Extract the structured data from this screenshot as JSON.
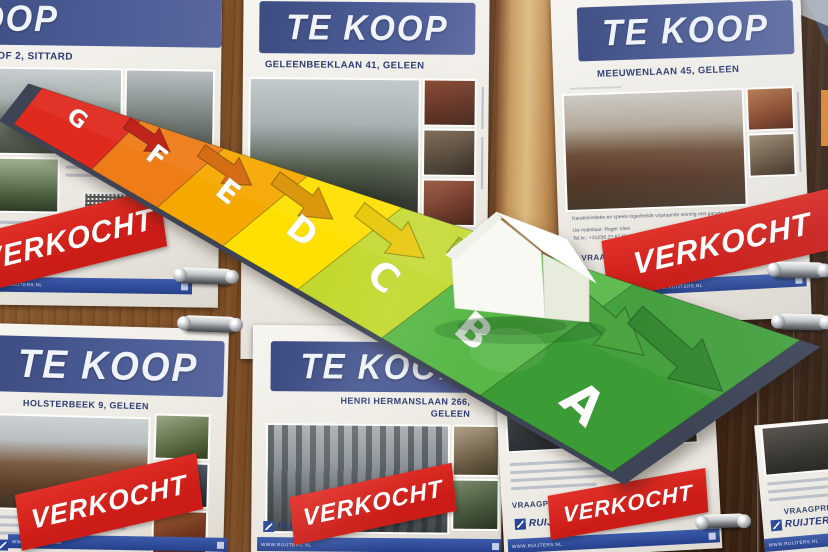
{
  "posters": {
    "p1": {
      "title": "TE KOOP",
      "address": "OF 2, SITTARD"
    },
    "p2": {
      "title": "TE KOOP",
      "address": "GELEENBEEKLAAN 41, GELEEN"
    },
    "p3": {
      "title": "TE KOOP",
      "address": "MEEUWENLAAN 45, GELEEN",
      "body_line1": "Karakteristieke en speels ingedeelde vrijstaande woning met garage en patiotuin.",
      "body_line2": "Uw makelaar: Roger Vliex",
      "body_line3": "Tel.nr.: +31(0)6 27 67 69 33, e-mail: r.vliex@ruijters.nl",
      "price_label": "VRAAGPRIJS"
    },
    "p4": {
      "title": "TE KOOP",
      "address": "HOLSTERBEEK 9, GELEEN"
    },
    "p5": {
      "title": "TE KOOP",
      "address_line1": "HENRI HERMANSLAAN 266,",
      "address_line2": "GELEEN"
    },
    "p6": {
      "price_label": "VRAAGPRIJS"
    },
    "p7": {
      "price_label": "VRAAGPRIJS"
    }
  },
  "stamps": {
    "label": "VERKOCHT"
  },
  "agency": {
    "name": "RUIJTERS",
    "website": "WWW.RUIJTERS.NL"
  },
  "energy_label": {
    "bands": [
      {
        "letter": "G",
        "color": "#e02a1d",
        "arrow_color": "#bd1a10"
      },
      {
        "letter": "F",
        "color": "#ee7c17",
        "arrow_color": "#d3650a"
      },
      {
        "letter": "E",
        "color": "#f6a800",
        "arrow_color": "#da9200"
      },
      {
        "letter": "D",
        "color": "#ffe000",
        "arrow_color": "#e6c600"
      },
      {
        "letter": "C",
        "color": "#c3d82e",
        "arrow_color": "#a7bd1e"
      },
      {
        "letter": "B",
        "color": "#58b847",
        "arrow_color": "#42a035"
      },
      {
        "letter": "A",
        "color": "#3b9b35",
        "arrow_color": "#2b8126"
      }
    ]
  }
}
